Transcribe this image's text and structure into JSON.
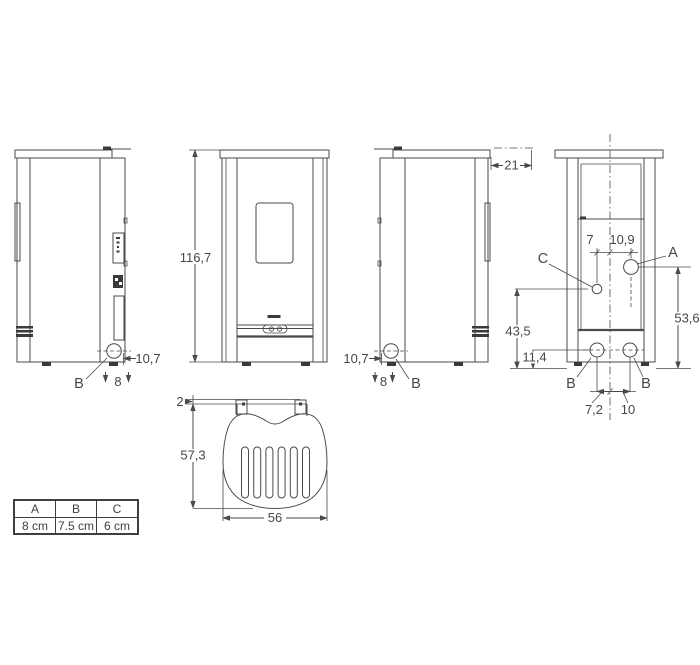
{
  "dims": {
    "height": "116,7",
    "left_outlet_offset": "10,7",
    "left_outlet_size": "8",
    "left_outlet_label": "B",
    "right_outlet_offset": "10,7",
    "right_outlet_size": "8",
    "right_outlet_label": "B",
    "top_rear_offset": "21",
    "rear_c_offset": "7",
    "rear_a_offset": "10,9",
    "rear_a_height": "53,6",
    "rear_c_height": "43,5",
    "rear_b_height": "11,4",
    "rear_b_left": "7,2",
    "rear_b_right": "10",
    "rear_label_a": "A",
    "rear_label_b1": "B",
    "rear_label_b2": "B",
    "rear_label_c": "C",
    "top_tab": "2",
    "top_depth": "57,3",
    "top_width": "56"
  },
  "table": {
    "headers": [
      "A",
      "B",
      "C"
    ],
    "rows": [
      [
        "8 cm",
        "7.5 cm",
        "6 cm"
      ]
    ]
  },
  "colors": {
    "line": "#4a4a4a",
    "text": "#474747",
    "background": "#ffffff"
  }
}
